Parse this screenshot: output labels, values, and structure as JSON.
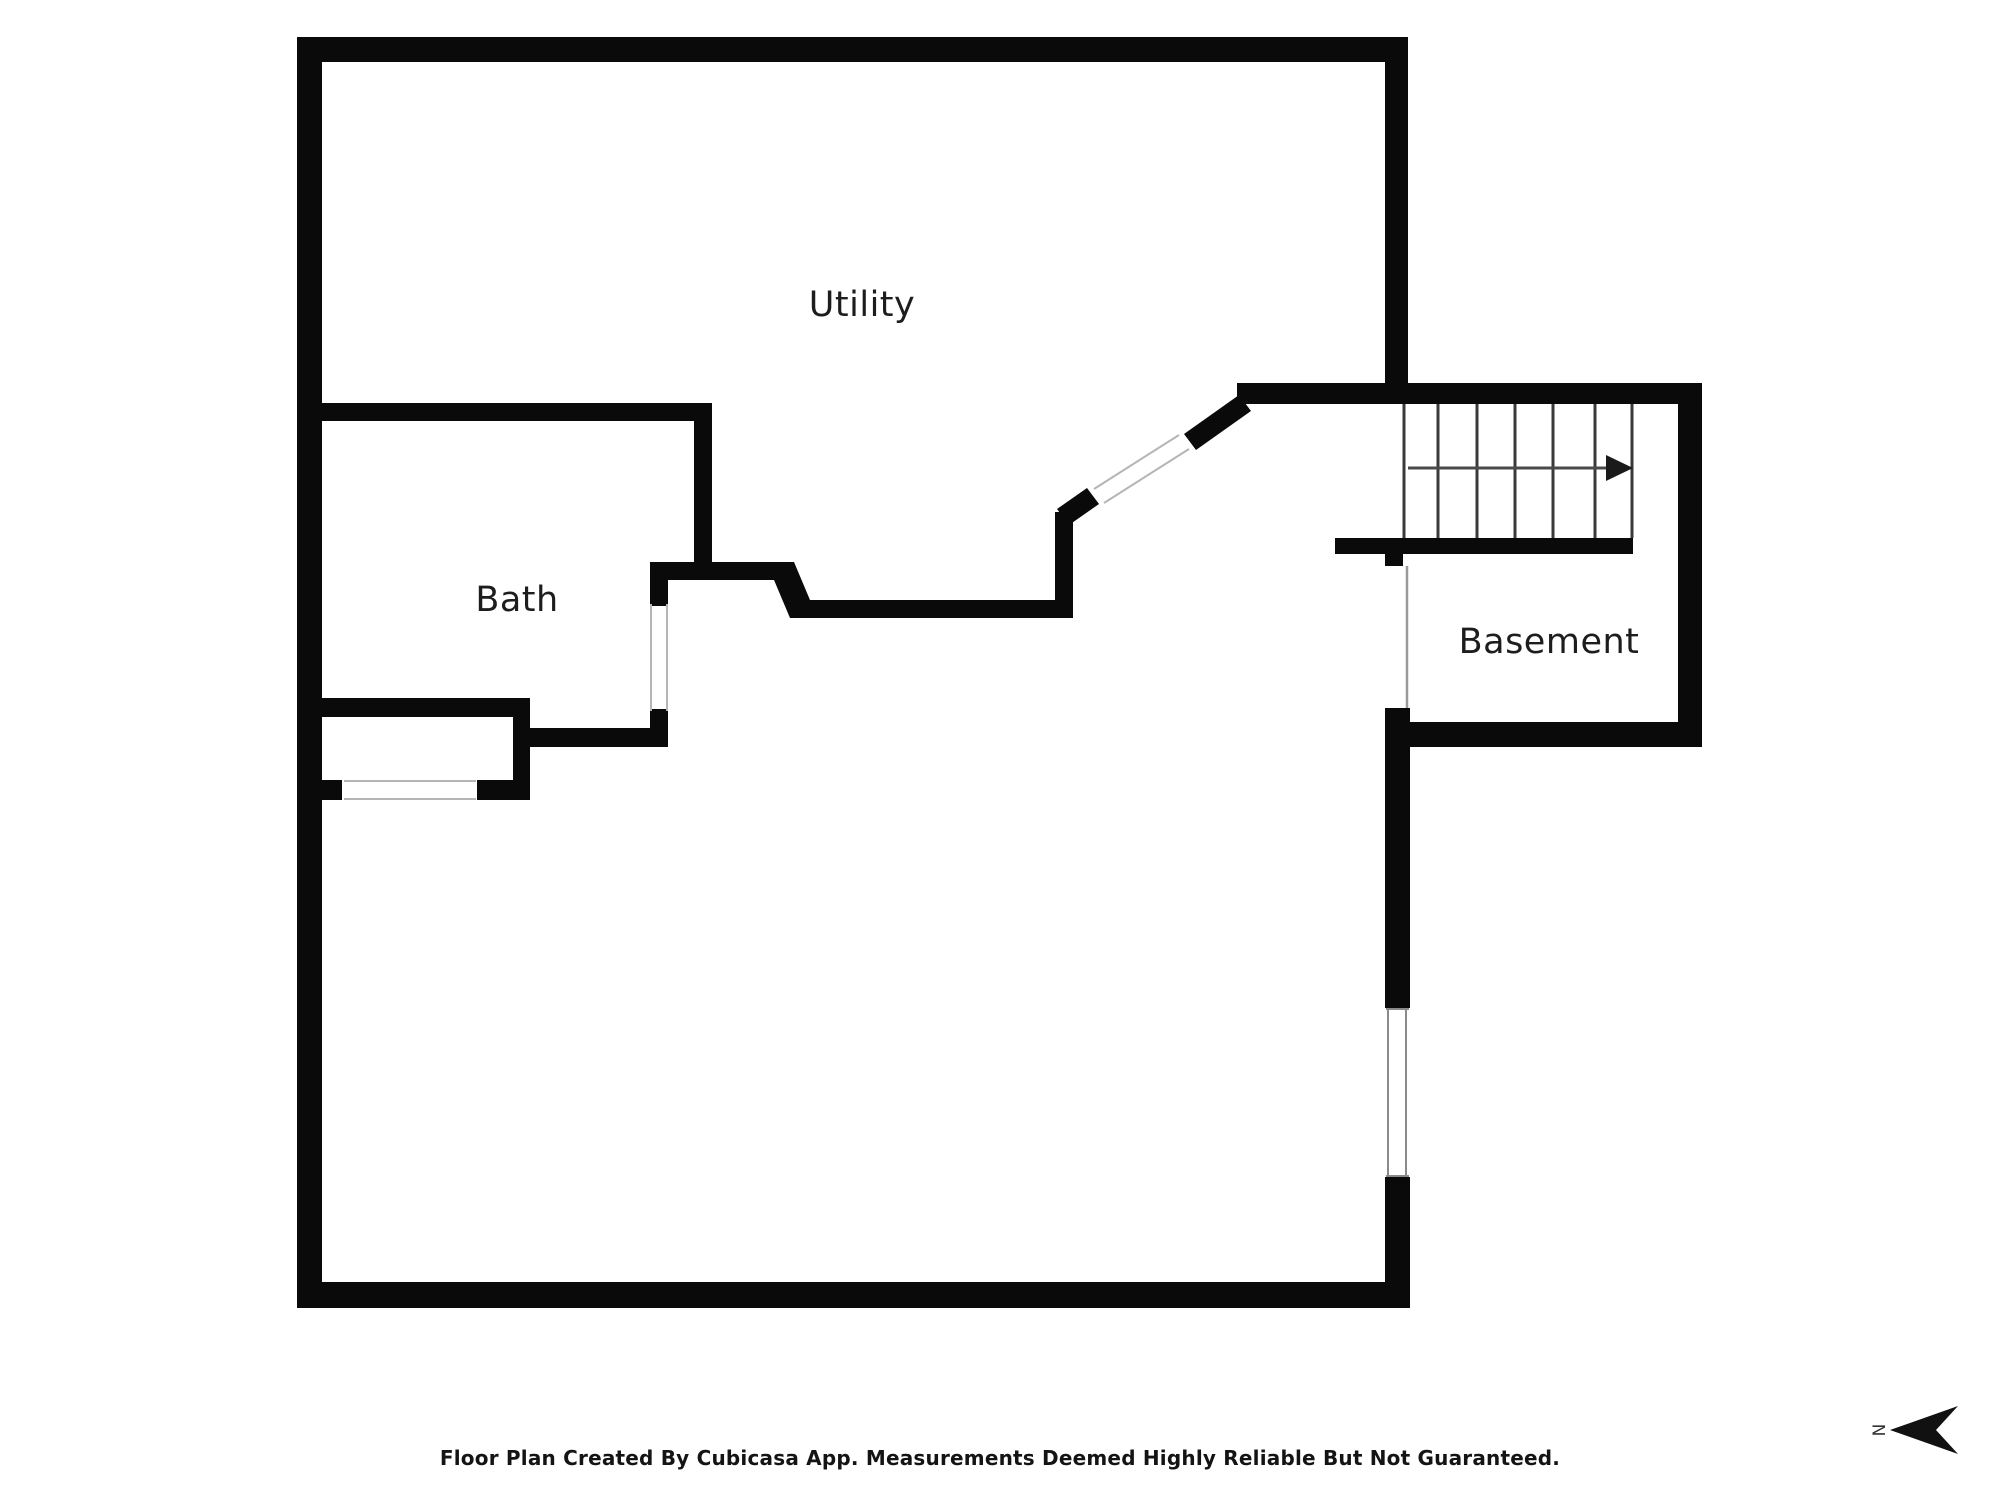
{
  "floor_plan": {
    "rooms": [
      {
        "id": "utility",
        "label": "Utility"
      },
      {
        "id": "bath",
        "label": "Bath"
      },
      {
        "id": "basement",
        "label": "Basement"
      }
    ],
    "stairs": {
      "tread_count": 6,
      "arrow_direction": "right"
    },
    "compass": {
      "letter": "N",
      "arrow_direction": "left"
    },
    "colors": {
      "wall": "#0a0a0a",
      "thin_line": "#9a9a9a",
      "opening_line": "#b5b5b5",
      "stair_line": "#3a3a3a",
      "label_text": "#1d1d1d",
      "background": "#ffffff"
    }
  },
  "footer": {
    "disclaimer": "Floor Plan Created By Cubicasa App. Measurements Deemed Highly Reliable But Not Guaranteed."
  }
}
